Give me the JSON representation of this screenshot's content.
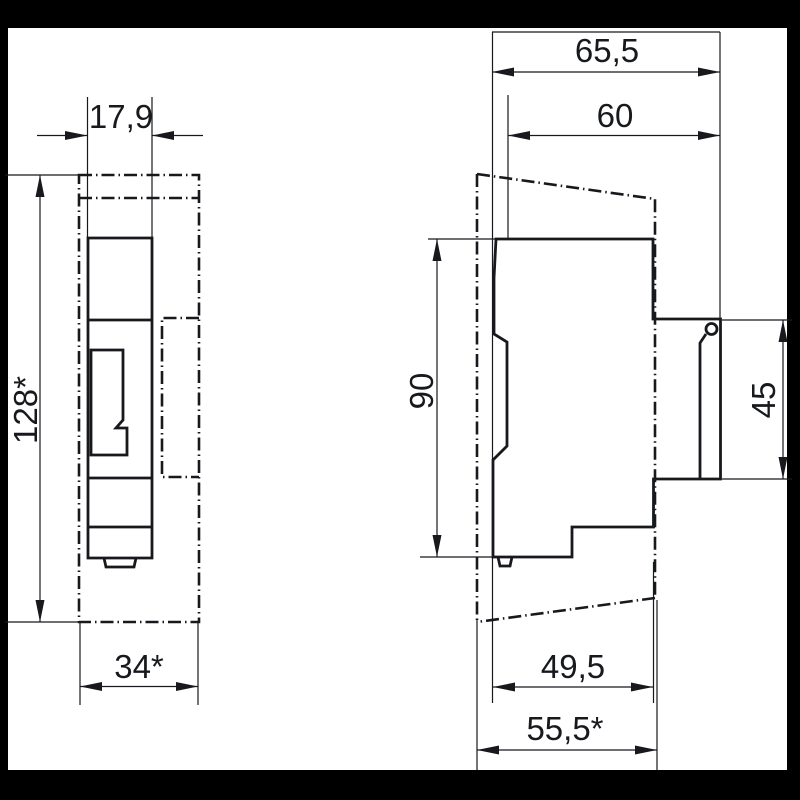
{
  "views": {
    "front": {
      "dimensions": {
        "top_width": "17,9",
        "overall_height": "128*",
        "overall_width": "34*"
      }
    },
    "side": {
      "dimensions": {
        "overall_depth": "65,5",
        "upper_depth": "60",
        "front_height": "90",
        "rail_recess_height": "45",
        "lower_depth": "49,5",
        "lower_overall_depth": "55,5*"
      }
    }
  },
  "colors": {
    "background": "#000000",
    "paper": "#ffffff",
    "line": "#17191d"
  }
}
